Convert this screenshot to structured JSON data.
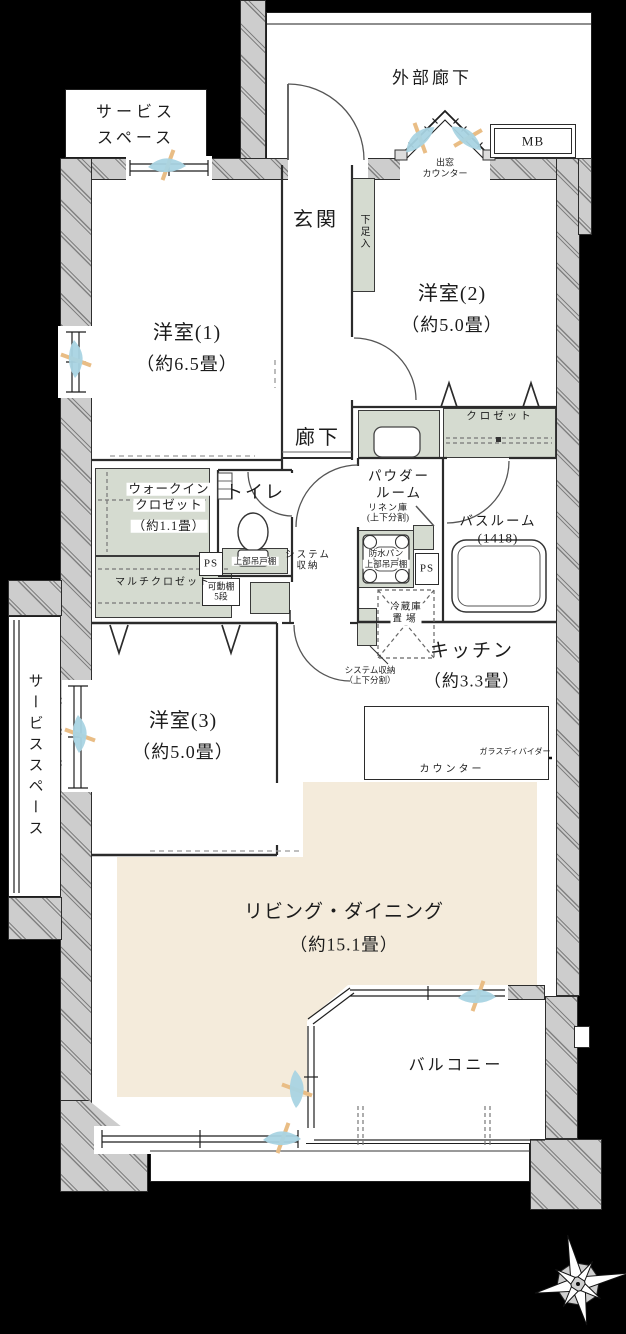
{
  "colors": {
    "background": "#000000",
    "wall_gray": "#cdcdcd",
    "closet_green": "#d5dbd0",
    "ld_floor_beige": "#f4ebdb",
    "airflow_blue": "#a9d4e3",
    "airflow_orange": "#e9bd85",
    "line_dark": "#1e1e1e"
  },
  "icons": [
    "compass-rose",
    "bathtub",
    "toilet-bowl",
    "wash-basin",
    "kitchen-sink",
    "gas-stove",
    "washer-pan",
    "refrigerator-space",
    "door-arc",
    "window-airflow"
  ],
  "labels": {
    "ext_corridor": "外部廊下",
    "service_top": {
      "l1": "サービス",
      "l2": "スペース"
    },
    "mb": "MB",
    "bay": {
      "l1": "出窓",
      "l2": "カウンター"
    },
    "genkan": "玄関",
    "shoe": "下足入",
    "room1": {
      "name": "洋室(1)",
      "size": "（約6.5畳）"
    },
    "room2": {
      "name": "洋室(2)",
      "size": "（約5.0畳）"
    },
    "room3": {
      "name": "洋室(3)",
      "size": "（約5.0畳）"
    },
    "hall": "廊下",
    "closet2": "クロゼット",
    "powder": {
      "l1": "パウダー",
      "l2": "ルーム"
    },
    "linen": {
      "l1": "リネン庫",
      "l2": "(上下分割)"
    },
    "bath": {
      "l1": "バスルーム",
      "l2": "(1418)"
    },
    "wic": {
      "l1": "ウォークイン",
      "l2": "クロゼット",
      "l3": "（約1.1畳）"
    },
    "toilet": "トイレ",
    "ps_left": "PS",
    "ps_right": "PS",
    "upper_cabinet": "上部吊戸棚",
    "sys_hall": {
      "l1": "システム",
      "l2": "収納"
    },
    "multi_closet": "マルチクロゼット",
    "movable_shelf": {
      "l1": "可動棚",
      "l2": "5段"
    },
    "pan": {
      "l1": "防水パン",
      "l2": "上部吊戸棚"
    },
    "fridge": {
      "l1": "冷蔵庫",
      "l2": "置場"
    },
    "kitchen": {
      "name": "キッチン",
      "size": "（約3.3畳）"
    },
    "sys_kitchen": {
      "l1": "システム収納",
      "l2": "（上下分割）"
    },
    "counter": "カウンター",
    "glass_divider": "ガラスディバイダー",
    "ld": {
      "name": "リビング・ダイニング",
      "size": "（約15.1畳）"
    },
    "balcony": "バルコニー",
    "service_left": "サービススペース"
  }
}
